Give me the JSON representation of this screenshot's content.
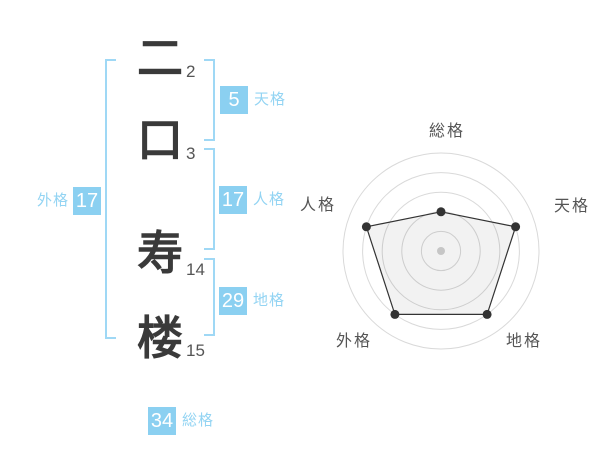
{
  "name_display": {
    "characters": [
      {
        "char": "二",
        "strokes": "2"
      },
      {
        "char": "口",
        "strokes": "3"
      },
      {
        "char": "寿",
        "strokes": "14"
      },
      {
        "char": "楼",
        "strokes": "15"
      }
    ],
    "badges": {
      "tenkaku": {
        "value": "5",
        "label": "天格"
      },
      "jinkaku": {
        "value": "17",
        "label": "人格"
      },
      "chikaku": {
        "value": "29",
        "label": "地格"
      },
      "soukaku": {
        "value": "34",
        "label": "総格"
      },
      "gaikaku": {
        "value": "17",
        "label": "外格"
      }
    },
    "colors": {
      "badge_bg": "#8bd0f1",
      "badge_text": "#ffffff",
      "label_text": "#93d4f3",
      "bracket": "#9fd8f5",
      "character_text": "#3a3a3a",
      "stroke_count_text": "#555555"
    }
  },
  "chart_data": {
    "type": "radar",
    "categories": [
      "総格",
      "天格",
      "地格",
      "外格",
      "人格"
    ],
    "values": [
      2,
      4,
      4,
      4,
      4
    ],
    "max": 5,
    "rings": 5,
    "grid": true,
    "legend": false,
    "colors": {
      "grid": "#d9d9d9",
      "line": "#333333",
      "point": "#333333",
      "fill": "#000000",
      "fill_opacity": 0.05,
      "center_dot": "#c6c6c6",
      "label": "#555555"
    }
  }
}
